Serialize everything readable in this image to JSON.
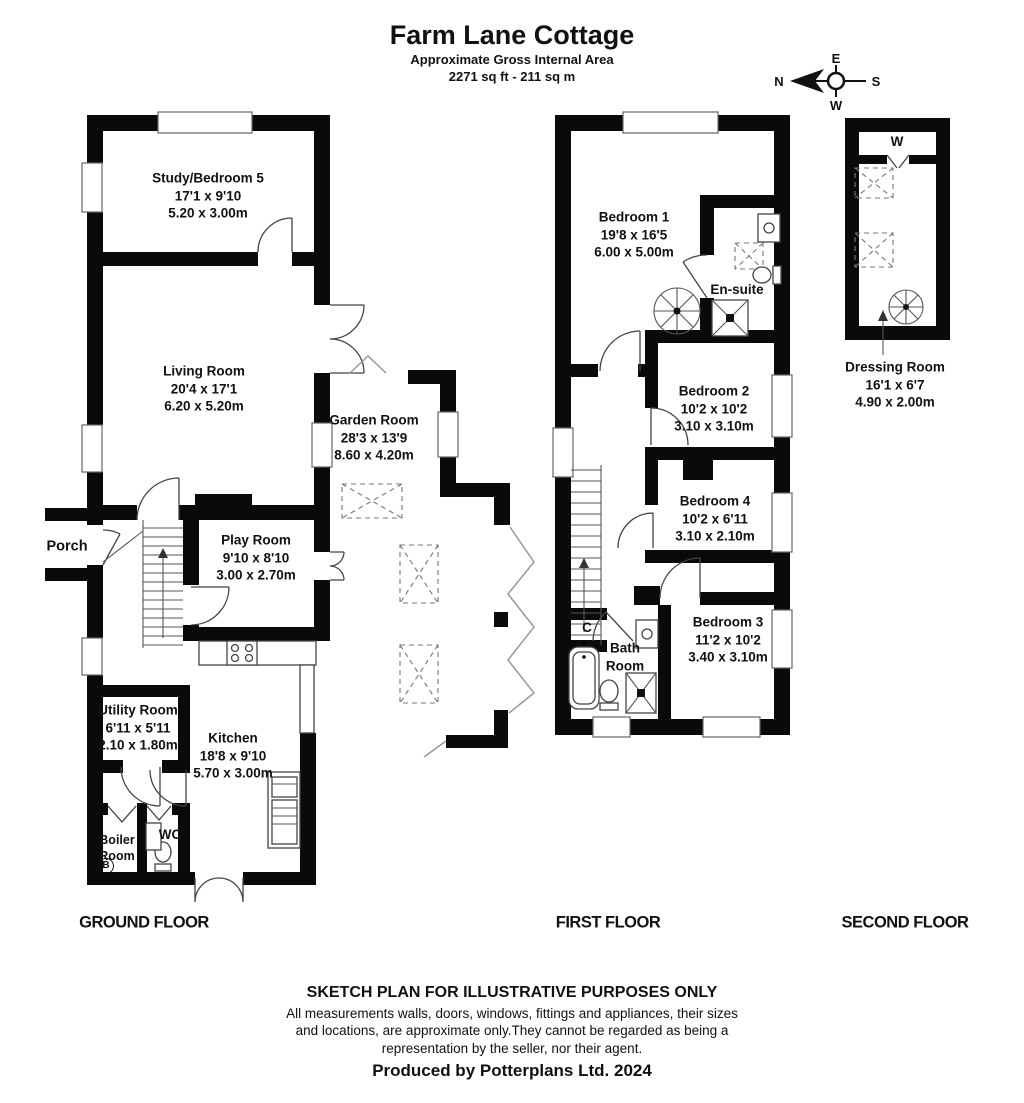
{
  "header": {
    "title": "Farm Lane Cottage",
    "subtitle": "Approximate Gross Internal Area",
    "area": "2271 sq ft - 211 sq m"
  },
  "compass": {
    "north": "N",
    "east": "E",
    "south": "S",
    "west": "W"
  },
  "floors": {
    "ground": {
      "label": "GROUND FLOOR"
    },
    "first": {
      "label": "FIRST FLOOR"
    },
    "second": {
      "label": "SECOND FLOOR"
    }
  },
  "rooms": {
    "study": {
      "name": "Study/Bedroom 5",
      "imperial": "17'1 x 9'10",
      "metric": "5.20 x 3.00m"
    },
    "living": {
      "name": "Living Room",
      "imperial": "20'4 x 17'1",
      "metric": "6.20 x 5.20m"
    },
    "garden": {
      "name": "Garden Room",
      "imperial": "28'3 x 13'9",
      "metric": "8.60 x 4.20m"
    },
    "play": {
      "name": "Play Room",
      "imperial": "9'10 x 8'10",
      "metric": "3.00 x 2.70m"
    },
    "porch": {
      "name": "Porch"
    },
    "utility": {
      "name": "Utility Room",
      "imperial": "6'11 x 5'11",
      "metric": "2.10 x 1.80m"
    },
    "kitchen": {
      "name": "Kitchen",
      "imperial": "18'8 x 9'10",
      "metric": "5.70 x 3.00m"
    },
    "boiler": {
      "line1": "Boiler",
      "line2": "Room",
      "tag": "B"
    },
    "wc": {
      "name": "WC"
    },
    "bedroom1": {
      "name": "Bedroom 1",
      "imperial": "19'8 x 16'5",
      "metric": "6.00 x 5.00m"
    },
    "ensuite": {
      "name": "En-suite"
    },
    "bedroom2": {
      "name": "Bedroom 2",
      "imperial": "10'2 x 10'2",
      "metric": "3.10 x 3.10m"
    },
    "bedroom4": {
      "name": "Bedroom 4",
      "imperial": "10'2 x 6'11",
      "metric": "3.10 x 2.10m"
    },
    "bedroom3": {
      "name": "Bedroom 3",
      "imperial": "11'2 x 10'2",
      "metric": "3.40 x 3.10m"
    },
    "bathroom": {
      "line1": "Bath",
      "line2": "Room"
    },
    "cupboard": {
      "name": "C"
    },
    "wardrobe": {
      "name": "W"
    },
    "dressing": {
      "name": "Dressing Room",
      "imperial": "16'1 x 6'7",
      "metric": "4.90 x 2.00m"
    }
  },
  "footer": {
    "disclaimer_title": "SKETCH PLAN FOR ILLUSTRATIVE PURPOSES ONLY",
    "disclaimer_lines": [
      "All measurements walls, doors, windows, fittings and appliances, their sizes",
      "and locations, are approximate only.They cannot be regarded as being a",
      "representation by the seller, nor their agent."
    ],
    "credit": "Produced by Potterplans Ltd. 2024"
  }
}
